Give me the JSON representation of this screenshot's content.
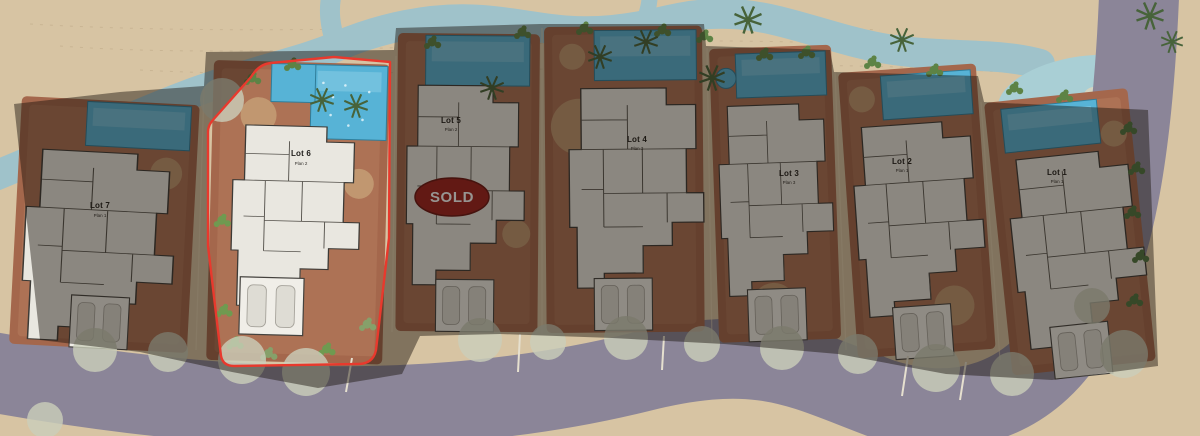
{
  "page": {
    "type": "residential-site-plan"
  },
  "lots": [
    {
      "label": "Lot 1",
      "plan": "Plan 1",
      "status": "available"
    },
    {
      "label": "Lot 2",
      "plan": "Plan 1",
      "status": "available"
    },
    {
      "label": "Lot 3",
      "plan": "Plan 3",
      "status": "available"
    },
    {
      "label": "Lot 4",
      "plan": "Plan 3",
      "status": "available"
    },
    {
      "label": "Lot 5",
      "plan": "Plan 2",
      "status": "sold"
    },
    {
      "label": "Lot 6",
      "plan": "Plan 2",
      "status": "highlighted"
    },
    {
      "label": "Lot 7",
      "plan": "Plan 1",
      "status": "available"
    }
  ],
  "sold_badge": {
    "label": "SOLD",
    "fill": "#9e201c",
    "text_color": "#ffffff"
  },
  "highlight": {
    "lot": "Lot 6",
    "outline_color": "#e8392d"
  },
  "colors": {
    "sand": "#d7c4a3",
    "water": "#9fc2ca",
    "lagoon": "#a9cfd5",
    "road": "#8b8598",
    "terracotta": "#a4674c",
    "building": "#e9e7e0",
    "pool": "#57b3d6",
    "vegetation": "#4f7540",
    "dim_overlay": "rgba(25,18,12,0.45)"
  }
}
